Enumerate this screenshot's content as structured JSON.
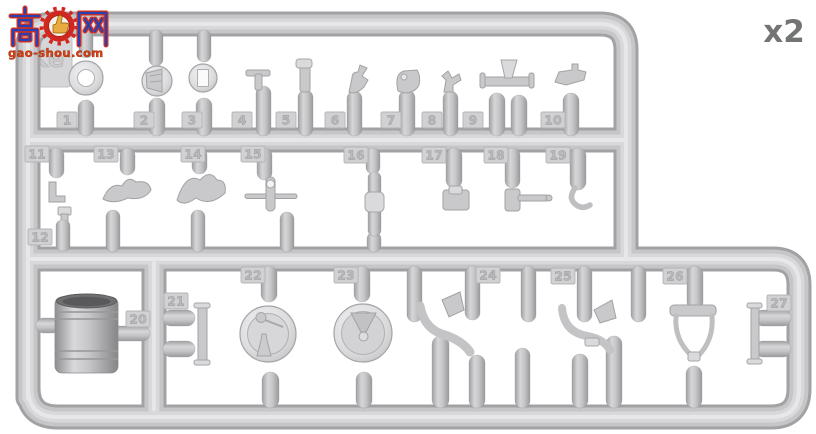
{
  "watermark": {
    "char_left": "高",
    "char_right": "网",
    "logo": "thumbs-up-gear-icon",
    "url": "gao-shou.com"
  },
  "quantity_label": "x2",
  "sprue": {
    "letter": "Ke",
    "material_color": "#c8c8ca",
    "background_color": "#ffffff",
    "part_tags": [
      "1",
      "2",
      "3",
      "4",
      "5",
      "6",
      "7",
      "8",
      "9",
      "10",
      "11",
      "12",
      "13",
      "14",
      "15",
      "16",
      "17",
      "18",
      "19",
      "20",
      "21",
      "22",
      "23",
      "24",
      "25",
      "26",
      "27"
    ]
  }
}
